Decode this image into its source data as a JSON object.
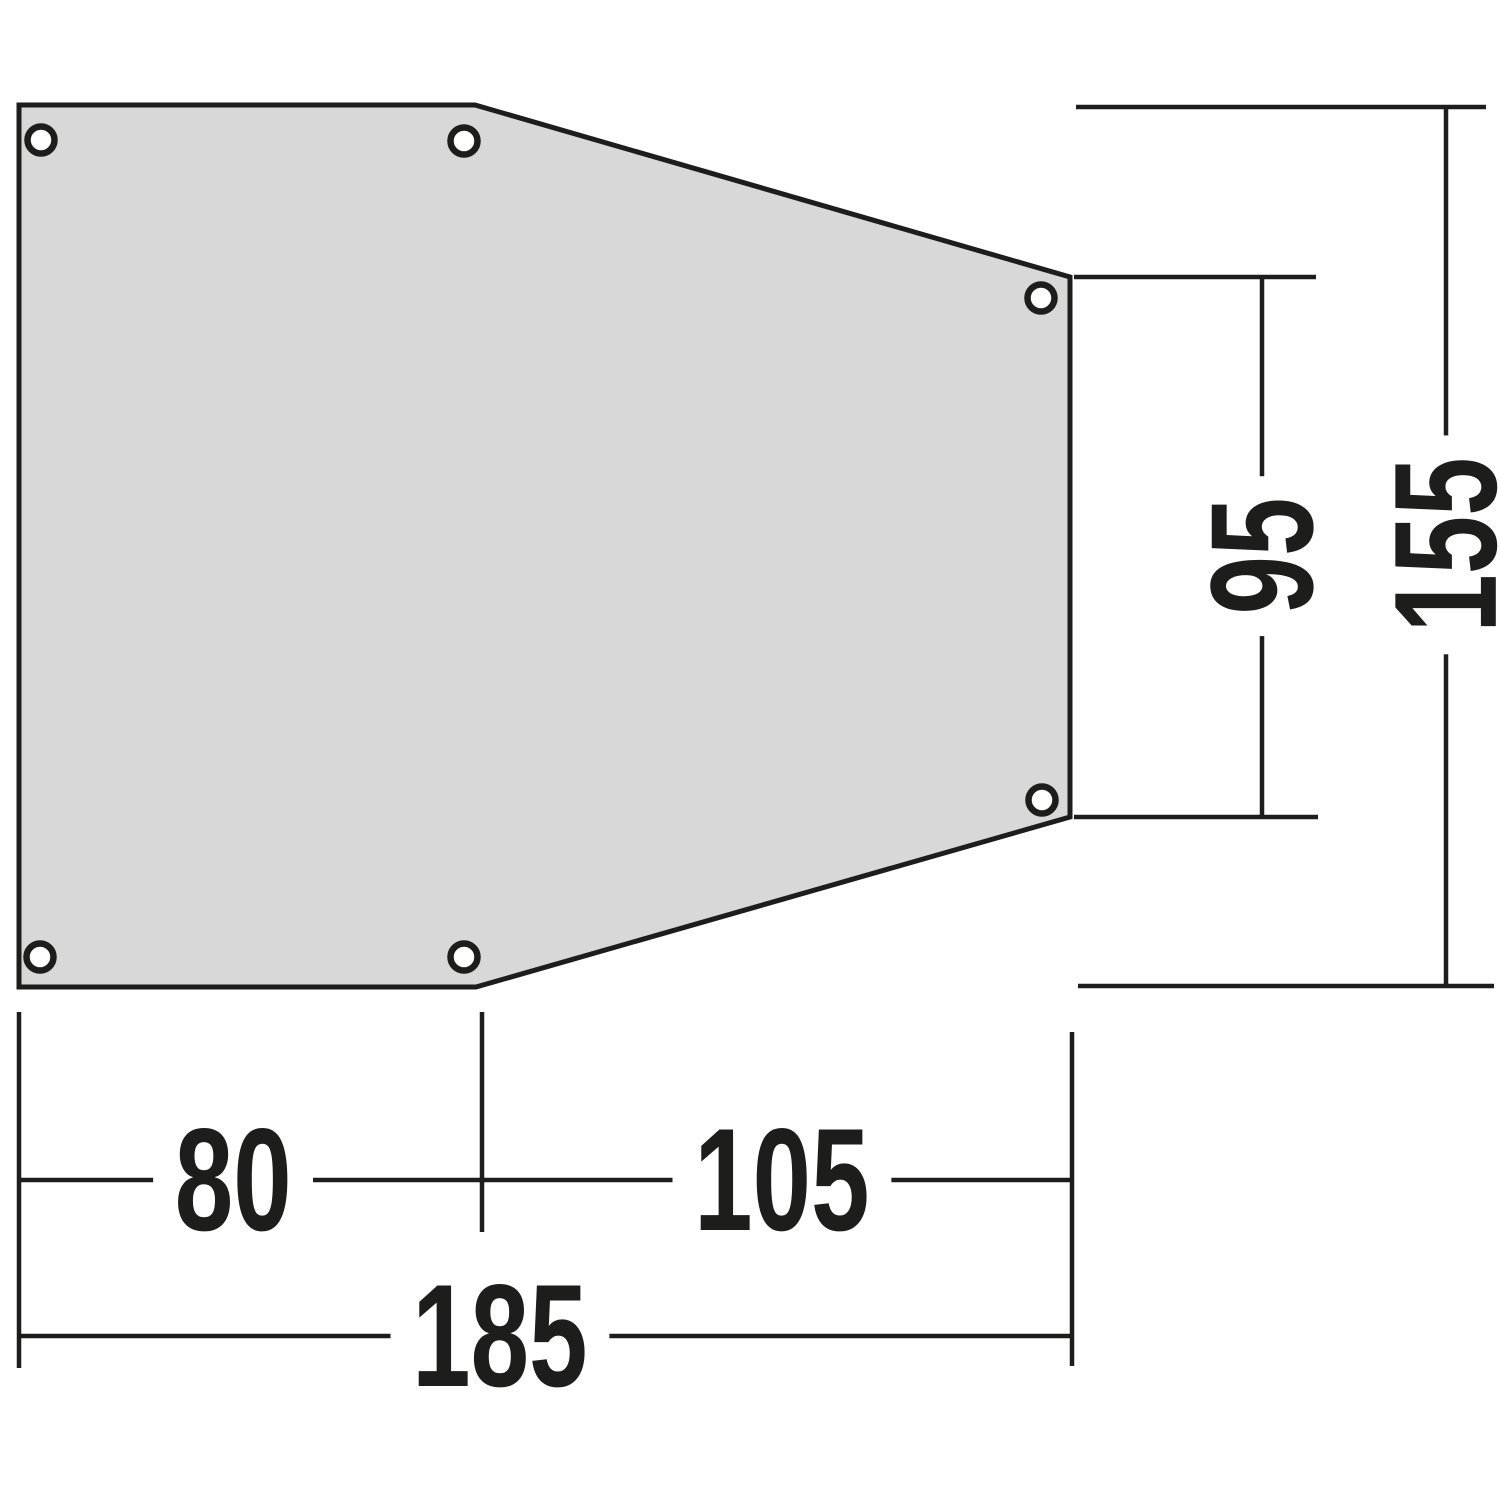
{
  "drawing": {
    "background": "#ffffff",
    "line_color": "#1d1d1b",
    "panel": {
      "description": "tapered-groundsheet-panel",
      "fill": "#d8d8d8",
      "grommet_count": "6"
    },
    "dimensions": {
      "bottom_left_width": "80",
      "bottom_right_width": "105",
      "bottom_total_width": "185",
      "right_inner_height": "95",
      "right_total_height": "155"
    }
  }
}
